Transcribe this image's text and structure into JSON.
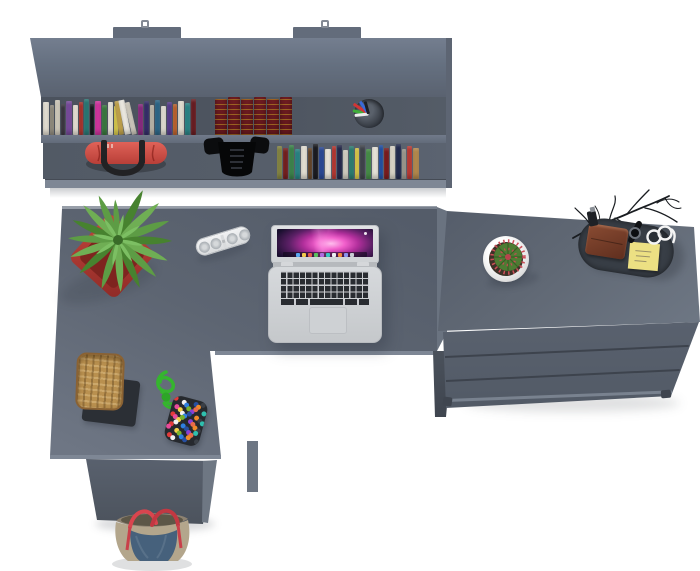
{
  "palette": {
    "bgWhite": "#ffffff",
    "panelMid": "#636c7b",
    "panelLight": "#707987",
    "panelDark": "#4d5460",
    "edgeLight": "#7e8795",
    "potRed": "#b23a32",
    "fernGreens": [
      "#5d9c45",
      "#47822f",
      "#6fae54",
      "#7cbf63"
    ],
    "bagRed": "#d4554c",
    "strapBlack": "#2a2a2c",
    "basketTan": "#b9904f",
    "ropeGreen": "#35b52e",
    "pouchDark": "#26292e",
    "denimBlue": "#46617c",
    "toteTan": "#b5a78e",
    "handleRed": "#d9454e",
    "trayDark": "#383e46",
    "walletBrown": "#82452f",
    "stickyYellow": "#ece083",
    "cactusGreen": "#4e7c33",
    "cactusSpineRed": "#cc4f58",
    "antiqueMaroon": "#5e161a",
    "antiqueGold": "#c9a227"
  },
  "shelf": {
    "books_row1": [
      {
        "w": 6,
        "h": 33,
        "c": "#e9e4d8"
      },
      {
        "w": 4,
        "h": 30,
        "c": "#9a9486"
      },
      {
        "w": 5,
        "h": 35,
        "c": "#d9d3c4"
      },
      {
        "w": 4,
        "h": 31,
        "c": "#3f3a45"
      },
      {
        "w": 6,
        "h": 34,
        "c": "#7b4da0"
      },
      {
        "w": 5,
        "h": 30,
        "c": "#efe9dd"
      },
      {
        "w": 4,
        "h": 33,
        "c": "#b5362f"
      },
      {
        "w": 5,
        "h": 36,
        "c": "#2a7d7a"
      },
      {
        "w": 4,
        "h": 31,
        "c": "#17181c"
      },
      {
        "w": 6,
        "h": 34,
        "c": "#d636a2"
      },
      {
        "w": 5,
        "h": 30,
        "c": "#3c7d41"
      },
      {
        "w": 5,
        "h": 33,
        "c": "#f2eee4"
      },
      {
        "w": 4,
        "h": 29,
        "c": "#e3d44e"
      },
      {
        "w": 5,
        "h": 34,
        "c": "#c9a94e",
        "r": -8
      },
      {
        "w": 6,
        "h": 35,
        "c": "#f4f1e8",
        "r": -11
      },
      {
        "w": 5,
        "h": 33,
        "c": "#d7d2c5",
        "r": -13
      },
      {
        "w": 5,
        "h": 31,
        "c": "#8e2c85"
      },
      {
        "w": 5,
        "h": 34,
        "c": "#37306e"
      },
      {
        "w": 4,
        "h": 30,
        "c": "#c6c1b4"
      },
      {
        "w": 5,
        "h": 35,
        "c": "#2f6b8e"
      },
      {
        "w": 5,
        "h": 29,
        "c": "#eae6db"
      },
      {
        "w": 5,
        "h": 33,
        "c": "#5b3f92"
      },
      {
        "w": 4,
        "h": 31,
        "c": "#c8682f"
      },
      {
        "w": 6,
        "h": 34,
        "c": "#e8e3d6"
      },
      {
        "w": 5,
        "h": 32,
        "c": "#2c8a8c"
      },
      {
        "w": 5,
        "h": 36,
        "c": "#6e1f24"
      }
    ],
    "antique_count": 6,
    "books_row2": [
      {
        "w": 5,
        "h": 33,
        "c": "#8a8a45"
      },
      {
        "w": 5,
        "h": 31,
        "c": "#7a2121"
      },
      {
        "w": 5,
        "h": 34,
        "c": "#3f8a4f"
      },
      {
        "w": 5,
        "h": 30,
        "c": "#2a8a8a"
      },
      {
        "w": 6,
        "h": 33,
        "c": "#ece7db"
      },
      {
        "w": 4,
        "h": 31,
        "c": "#6b4a2b"
      },
      {
        "w": 5,
        "h": 35,
        "c": "#1c1d22"
      },
      {
        "w": 5,
        "h": 32,
        "c": "#2c4b9c"
      },
      {
        "w": 6,
        "h": 30,
        "c": "#efeadf"
      },
      {
        "w": 4,
        "h": 33,
        "c": "#c23a34"
      },
      {
        "w": 5,
        "h": 34,
        "c": "#272a4e"
      },
      {
        "w": 5,
        "h": 29,
        "c": "#ddd8ca"
      },
      {
        "w": 5,
        "h": 33,
        "c": "#2e8376"
      },
      {
        "w": 4,
        "h": 31,
        "c": "#e6d44c"
      },
      {
        "w": 5,
        "h": 34,
        "c": "#43474f"
      },
      {
        "w": 5,
        "h": 30,
        "c": "#49934a"
      },
      {
        "w": 6,
        "h": 32,
        "c": "#f0ece1"
      },
      {
        "w": 4,
        "h": 34,
        "c": "#2456b0"
      },
      {
        "w": 5,
        "h": 31,
        "c": "#801d20"
      },
      {
        "w": 5,
        "h": 33,
        "c": "#e4dfd2"
      },
      {
        "w": 5,
        "h": 35,
        "c": "#232c52"
      },
      {
        "w": 4,
        "h": 30,
        "c": "#a7a296"
      },
      {
        "w": 5,
        "h": 33,
        "c": "#c33d37"
      },
      {
        "w": 6,
        "h": 31,
        "c": "#b98d4f"
      }
    ],
    "pen_colors": [
      "#3fae3a",
      "#d23535",
      "#3a6ad8",
      "#ececec",
      "#1d2025"
    ]
  },
  "laptop": {
    "dock_colors": [
      "#5aa7f0",
      "#f2c94c",
      "#e05a4e",
      "#58c05e",
      "#b06be0",
      "#3ac6c2",
      "#eceff2",
      "#f08a3c",
      "#8a93f0",
      "#c8ccd2"
    ]
  },
  "beads": {
    "colors": [
      "#e23a3a",
      "#f2cf48",
      "#2f7fe0",
      "#8a3fd4",
      "#f08a2a",
      "#2fbfae",
      "#e84a9a",
      "#f2f2f2",
      "#7ab32a",
      "#274fa0",
      "#e86a4a",
      "#3a3f46"
    ],
    "count": 42
  }
}
